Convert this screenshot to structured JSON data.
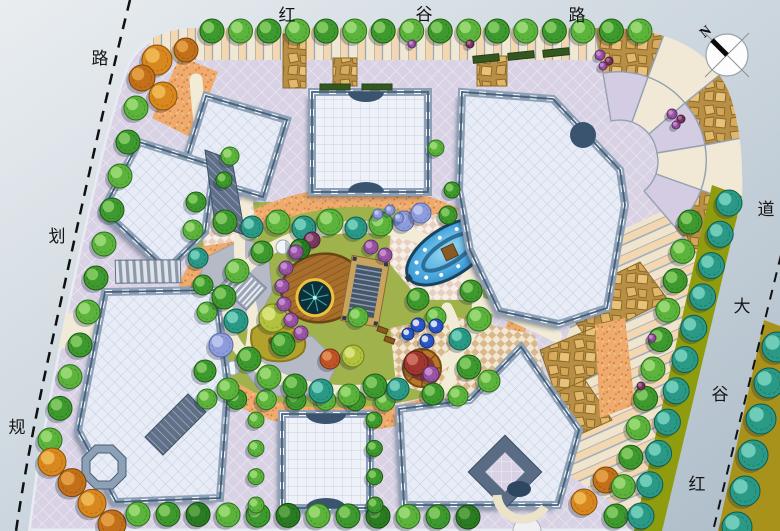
{
  "meta": {
    "title": "Residential quarter landscape master plan",
    "plan_type": "color site plan rendering"
  },
  "roads": {
    "top": {
      "name": "红谷路",
      "chars": [
        "红",
        "谷",
        "路"
      ]
    },
    "left": {
      "name": "规划路",
      "chars": [
        "规",
        "划",
        "路"
      ]
    },
    "right": {
      "name": "红谷大道",
      "chars": [
        "红",
        "谷",
        "大",
        "道"
      ]
    }
  },
  "compass": {
    "label": "N"
  },
  "palette": {
    "road": "#c3cfd8",
    "site_paving": "#d8d2e4",
    "cream_paving": "#f1e9d6",
    "peach_paving": "#f2d7b0",
    "flagstone": "#d9ab5e",
    "orange_gravel": "#eeab6d",
    "water": "#3fa0dc",
    "grass": "#9fb24c",
    "roof": "#e7ecf6",
    "building_band": "#8ea0b6",
    "olive_strip": "#8f9c0e",
    "ochre_strip": "#a8921c"
  },
  "features": {
    "pool": "lens-fountain-pool",
    "deck": "round-wood-deck",
    "pond": "lotus-pond",
    "pergola": "trellis-pergola",
    "gazebo": "round-gazebo",
    "umbrellas": "umbrella-plaza",
    "steps": "garden-steps",
    "domes": "tent-dome",
    "fan_plaza": "radial-paving-plaza",
    "compass": "north-arrow"
  },
  "vegetation": {
    "palette": {
      "g1": {
        "fill": "#3e9a2e",
        "edge": "#1e5c14",
        "light": "#8ed26a"
      },
      "g2": {
        "fill": "#5cb43c",
        "edge": "#2e7020",
        "light": "#a6e07e"
      },
      "dk": {
        "fill": "#2a7c22",
        "edge": "#154a10",
        "light": "#66aa4e"
      },
      "t": {
        "fill": "#2a9a86",
        "edge": "#0f5c4e",
        "light": "#7fd8c4"
      },
      "b": {
        "fill": "#8e9cdc",
        "edge": "#5868a8",
        "light": "#c6cdf2"
      },
      "p": {
        "fill": "#9a55a5",
        "edge": "#5e2e68",
        "light": "#cf97d8"
      },
      "p2": {
        "fill": "#7a3860",
        "edge": "#4a1e3a",
        "light": "#b87aa0"
      },
      "o": {
        "fill": "#d8881e",
        "edge": "#8a5208",
        "light": "#f2c25e"
      },
      "o2": {
        "fill": "#c2701a",
        "edge": "#7a4408",
        "light": "#eaa94e"
      },
      "r": {
        "fill": "#c05428",
        "edge": "#7a2e10",
        "light": "#e89a60"
      },
      "r2": {
        "fill": "#a03830",
        "edge": "#611c18",
        "light": "#d87a6a"
      },
      "y": {
        "fill": "#b2c23e",
        "edge": "#72801c",
        "light": "#e0ea8a"
      },
      "u": {
        "fill": "#2c58cc",
        "edge": "#14306e",
        "light": "#ffffff"
      }
    },
    "rows": [
      {
        "target": "tree-row-top",
        "from": [
          212,
          31
        ],
        "to": [
          640,
          31
        ],
        "n": 16,
        "r": 12,
        "types": [
          "g1",
          "g2"
        ]
      },
      {
        "target": "tree-row-left-a",
        "from": [
          136,
          108
        ],
        "to": [
          88,
          312
        ],
        "n": 7,
        "r": 12,
        "types": [
          "g2",
          "g1"
        ]
      },
      {
        "target": "tree-row-left-b",
        "from": [
          80,
          345
        ],
        "to": [
          50,
          440
        ],
        "n": 4,
        "r": 12,
        "types": [
          "g1",
          "g2"
        ]
      },
      {
        "target": "tree-row-left-c",
        "from": [
          52,
          462
        ],
        "to": [
          112,
          524
        ],
        "n": 4,
        "r": 14,
        "types": [
          "o",
          "o2"
        ]
      },
      {
        "target": "tree-row-bottom",
        "from": [
          138,
          514
        ],
        "to": [
          468,
          517
        ],
        "n": 12,
        "r": 12,
        "types": [
          "g2",
          "g1",
          "dk"
        ]
      },
      {
        "target": "tree-row-bottom-orange",
        "from": [
          584,
          502
        ],
        "to": [
          606,
          480
        ],
        "n": 2,
        "r": 13,
        "types": [
          "o",
          "o2"
        ]
      },
      {
        "target": "tree-row-right-edge",
        "from": [
          690,
          222
        ],
        "to": [
          616,
          516
        ],
        "n": 11,
        "r": 12,
        "types": [
          "g1",
          "g2"
        ]
      },
      {
        "target": "tree-row-median",
        "from": [
          729,
          203
        ],
        "to": [
          641,
          516
        ],
        "n": 11,
        "r": 13,
        "types": [
          "t"
        ]
      },
      {
        "target": "tree-row-far-right",
        "from": [
          777,
          347
        ],
        "to": [
          737,
          527
        ],
        "n": 6,
        "r": 15,
        "types": [
          "t"
        ]
      },
      {
        "target": "tree-row-mid",
        "from": [
          207,
          399
        ],
        "to": [
          385,
          401
        ],
        "n": 7,
        "r": 10,
        "types": [
          "g2",
          "g1"
        ]
      },
      {
        "target": "tree-col-a",
        "from": [
          256,
          420
        ],
        "to": [
          256,
          505
        ],
        "n": 4,
        "r": 8,
        "types": [
          "g2"
        ]
      },
      {
        "target": "tree-col-b",
        "from": [
          374,
          420
        ],
        "to": [
          375,
          505
        ],
        "n": 4,
        "r": 8,
        "types": [
          "g1"
        ]
      }
    ],
    "garden_trees": [
      [
        225,
        222,
        12,
        "g1"
      ],
      [
        252,
        227,
        11,
        "t"
      ],
      [
        278,
        222,
        12,
        "g2"
      ],
      [
        304,
        228,
        12,
        "t"
      ],
      [
        330,
        222,
        13,
        "g2"
      ],
      [
        356,
        228,
        11,
        "t"
      ],
      [
        381,
        224,
        12,
        "g2"
      ],
      [
        404,
        221,
        10,
        "b"
      ],
      [
        421,
        213,
        10,
        "b"
      ],
      [
        312,
        240,
        8,
        "p2"
      ],
      [
        300,
        249,
        10,
        "dk"
      ],
      [
        262,
        252,
        11,
        "g1"
      ],
      [
        196,
        202,
        10,
        "g1"
      ],
      [
        193,
        230,
        10,
        "g2"
      ],
      [
        198,
        258,
        10,
        "t"
      ],
      [
        203,
        285,
        10,
        "g1"
      ],
      [
        207,
        312,
        10,
        "g2"
      ],
      [
        230,
        156,
        9,
        "g2"
      ],
      [
        224,
        180,
        8,
        "g1"
      ],
      [
        237,
        271,
        12,
        "g2"
      ],
      [
        224,
        297,
        12,
        "g1"
      ],
      [
        236,
        321,
        12,
        "t"
      ],
      [
        221,
        345,
        12,
        "b"
      ],
      [
        249,
        359,
        12,
        "g1"
      ],
      [
        205,
        371,
        11,
        "g1"
      ],
      [
        228,
        389,
        11,
        "g2"
      ],
      [
        269,
        377,
        12,
        "g2"
      ],
      [
        295,
        386,
        12,
        "g1"
      ],
      [
        321,
        391,
        12,
        "t"
      ],
      [
        349,
        395,
        11,
        "g2"
      ],
      [
        375,
        386,
        12,
        "g1"
      ],
      [
        398,
        389,
        11,
        "t"
      ],
      [
        273,
        318,
        14,
        "y"
      ],
      [
        283,
        344,
        12,
        "g1"
      ],
      [
        330,
        359,
        10,
        "r"
      ],
      [
        353,
        356,
        11,
        "y"
      ],
      [
        358,
        317,
        10,
        "g2"
      ],
      [
        418,
        299,
        11,
        "g1"
      ],
      [
        436,
        317,
        10,
        "g2"
      ],
      [
        460,
        339,
        11,
        "t"
      ],
      [
        479,
        319,
        12,
        "g2"
      ],
      [
        471,
        291,
        11,
        "g1"
      ],
      [
        469,
        367,
        12,
        "g1"
      ],
      [
        489,
        381,
        11,
        "g2"
      ],
      [
        433,
        394,
        11,
        "g1"
      ],
      [
        458,
        396,
        10,
        "g2"
      ],
      [
        296,
        252,
        7,
        "p"
      ],
      [
        286,
        268,
        7,
        "p"
      ],
      [
        282,
        286,
        7,
        "p"
      ],
      [
        284,
        304,
        7,
        "p"
      ],
      [
        291,
        320,
        7,
        "p"
      ],
      [
        301,
        333,
        7,
        "p"
      ],
      [
        371,
        247,
        7,
        "p"
      ],
      [
        385,
        255,
        7,
        "p"
      ],
      [
        378,
        214,
        5,
        "b"
      ],
      [
        390,
        210,
        5,
        "b"
      ],
      [
        399,
        218,
        5,
        "b"
      ],
      [
        448,
        215,
        9,
        "g1"
      ],
      [
        436,
        148,
        8,
        "g2"
      ],
      [
        452,
        190,
        8,
        "g1"
      ],
      [
        416,
        363,
        12,
        "r2"
      ],
      [
        431,
        374,
        8,
        "p"
      ],
      [
        600,
        55,
        5,
        "p"
      ],
      [
        609,
        61,
        4,
        "p2"
      ],
      [
        603,
        66,
        4,
        "p"
      ],
      [
        672,
        114,
        5,
        "p"
      ],
      [
        681,
        119,
        4,
        "p2"
      ],
      [
        676,
        125,
        4,
        "p"
      ],
      [
        652,
        338,
        4,
        "p"
      ],
      [
        641,
        386,
        4,
        "p2"
      ],
      [
        412,
        44,
        4,
        "p"
      ],
      [
        470,
        44,
        4,
        "p2"
      ],
      [
        157,
        60,
        15,
        "o"
      ],
      [
        142,
        78,
        13,
        "o2"
      ],
      [
        163,
        96,
        14,
        "o"
      ],
      [
        186,
        50,
        12,
        "o2"
      ],
      [
        418,
        325,
        7,
        "u"
      ],
      [
        436,
        326,
        7,
        "u"
      ],
      [
        427,
        341,
        7,
        "u"
      ],
      [
        408,
        334,
        6,
        "u"
      ]
    ]
  }
}
